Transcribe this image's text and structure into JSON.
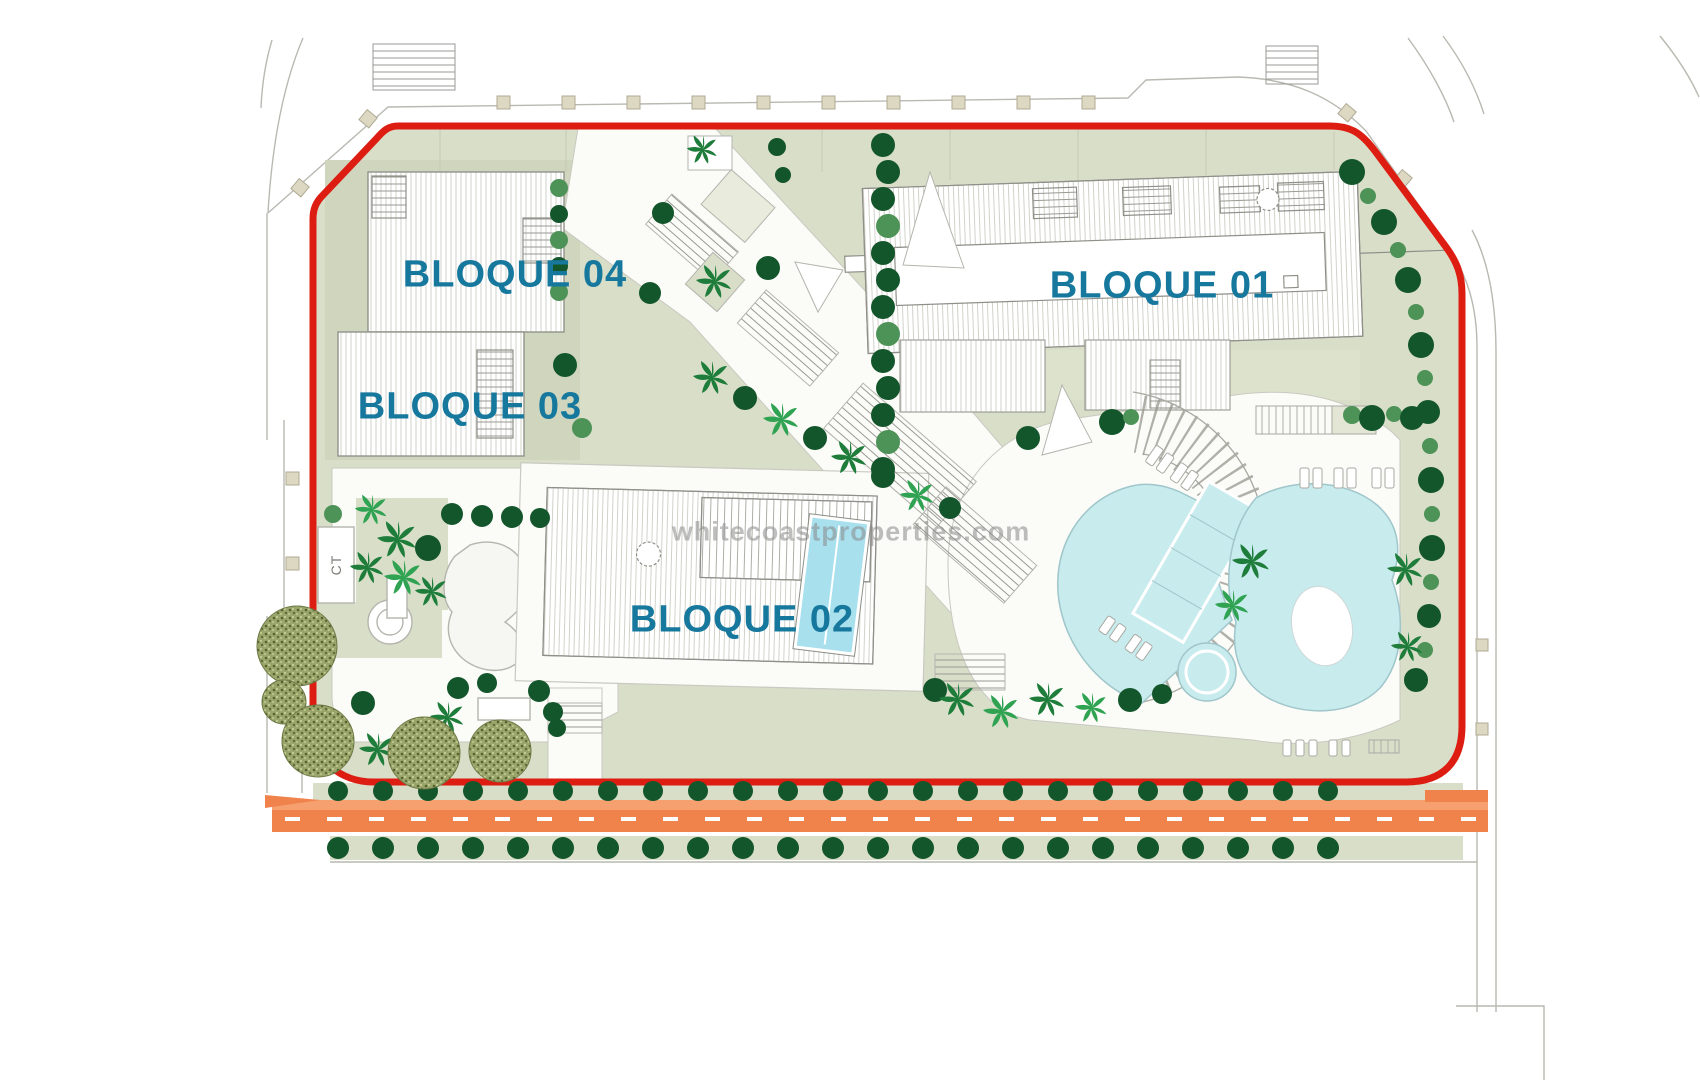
{
  "title": "Residential development site plan",
  "labels": {
    "b01": "BLOQUE 01",
    "b02": "BLOQUE 02",
    "b03": "BLOQUE 03",
    "b04": "BLOQUE 04",
    "ct": "CT"
  },
  "watermark": {
    "text": "whitecoastproperties.com"
  },
  "colors": {
    "boundary": "#dd1d12",
    "label": "#17789e",
    "watermark": "#8a8a8a",
    "sage": "#d9dec9",
    "sageDark": "#cfd6bd",
    "sageLight": "#dde2cd",
    "pool": "#c8ebee",
    "poolDeep": "#a8e0ee",
    "poolEdge": "#9fc6ca",
    "road": "#f0824c",
    "roadLight": "#f5a06e",
    "treeDark": "#14562b",
    "treeMed": "#4d9257",
    "palm": "#1e7d3a",
    "palmLight": "#2fa352",
    "olive": "#9aa56b",
    "line": "#b9b9b2",
    "bldLine": "#8f8f89",
    "white": "#fbfbf8"
  }
}
